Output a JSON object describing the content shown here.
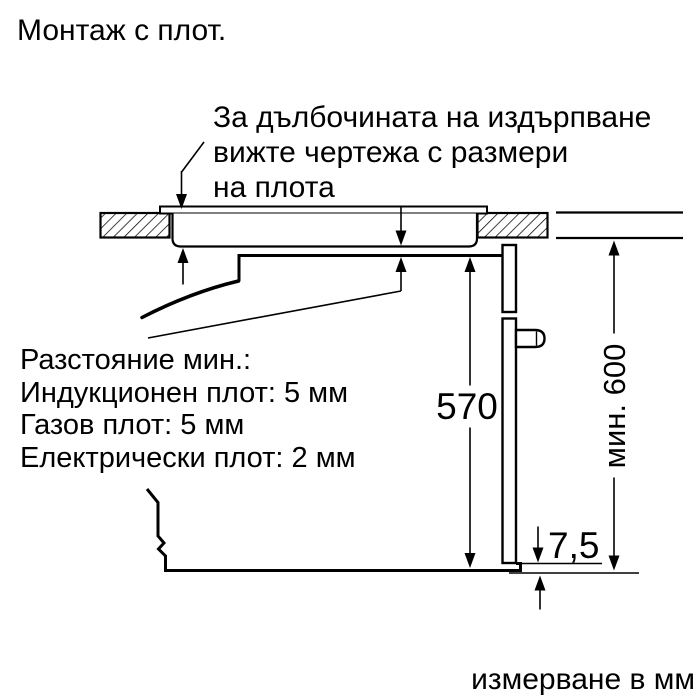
{
  "title": "Монтаж с плот.",
  "annotation": {
    "line1": "За дълбочината на издърпване",
    "line2": "вижте чертежа с размери",
    "line3": "на плота"
  },
  "clearance": {
    "line1": "Разстояние мин.:",
    "line2": "Индукционен плот: 5 мм",
    "line3": "Газов плот: 5 мм",
    "line4": "Електрически плот: 2 мм"
  },
  "dimensions": {
    "oven_height": "570",
    "min_niche_height": "мин. 600",
    "bottom_clearance": "7,5"
  },
  "footer": "измерване в мм",
  "colors": {
    "line": "#000000",
    "background": "#ffffff"
  }
}
